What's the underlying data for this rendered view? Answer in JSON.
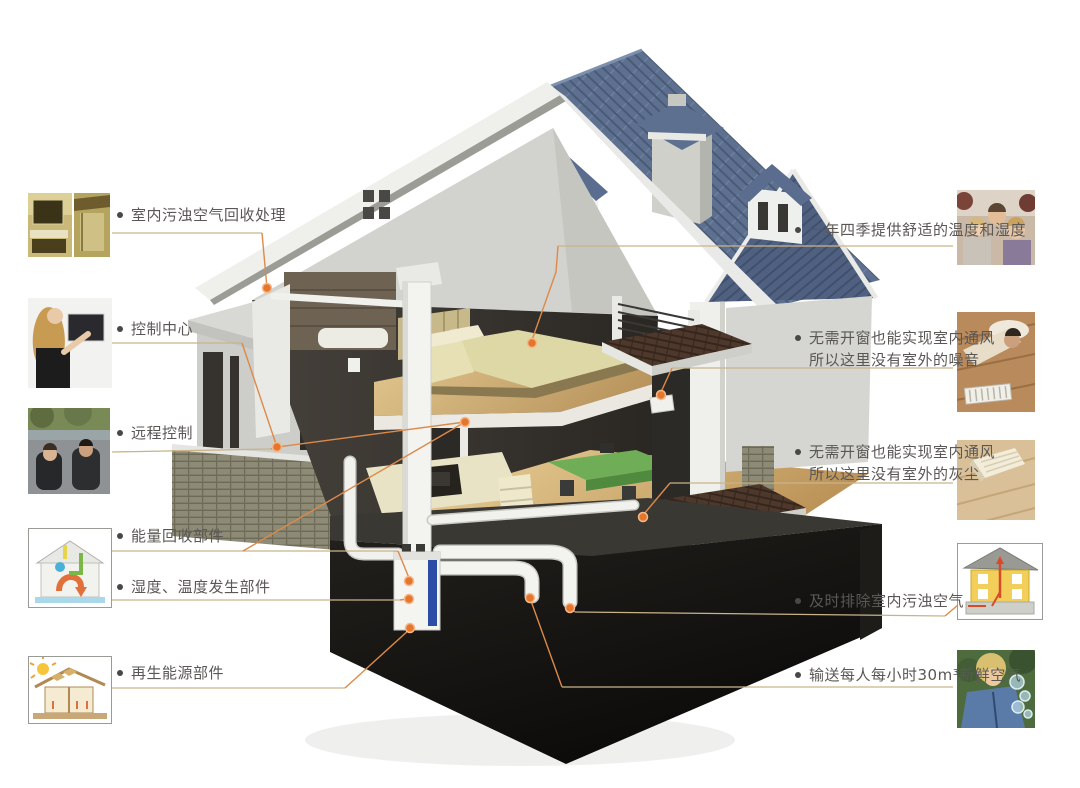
{
  "diagram": {
    "subject": "house-ventilation-cutaway",
    "bullet_glyph": "dot",
    "colors": {
      "leader_line": "#dc8a4a",
      "underline": "#c9b489",
      "connection_dot": "#e4762e",
      "label_text": "#5a5755",
      "roof_blue": "#5d7090",
      "basement_black": "#121110"
    }
  },
  "left_labels": [
    {
      "text": "室内污浊空气回收处理",
      "thumb_icon": "bathroom-interior-photo"
    },
    {
      "text": "控制中心",
      "thumb_icon": "woman-touchscreen-photo"
    },
    {
      "text": "远程控制",
      "thumb_icon": "remote-control-in-car-photo"
    },
    {
      "text": "能量回收部件",
      "thumb_icon": "energy-recovery-diagram"
    },
    {
      "text": "湿度、温度发生部件",
      "thumb_icon": "energy-recovery-diagram"
    },
    {
      "text": "再生能源部件",
      "thumb_icon": "renewable-energy-house-diagram"
    }
  ],
  "right_labels": [
    {
      "line1": "一年四季提供舒适的温度和湿度",
      "line2": "",
      "thumb_icon": "family-sofa-photo"
    },
    {
      "line1": "无需开窗也能实现室内通风",
      "line2": "所以这里没有室外的噪音",
      "thumb_icon": "man-resting-on-floor-photo"
    },
    {
      "line1": "无需开窗也能实现室内通风",
      "line2": "所以这里没有室外的灰尘",
      "thumb_icon": "book-on-clean-floor-photo"
    },
    {
      "line1": "及时排除室内污浊空气",
      "line2": "",
      "thumb_icon": "exhaust-air-house-diagram"
    },
    {
      "line1": "输送每人每小时30m³新鲜空气",
      "line2": "",
      "thumb_icon": "child-blowing-bubbles-photo"
    }
  ]
}
